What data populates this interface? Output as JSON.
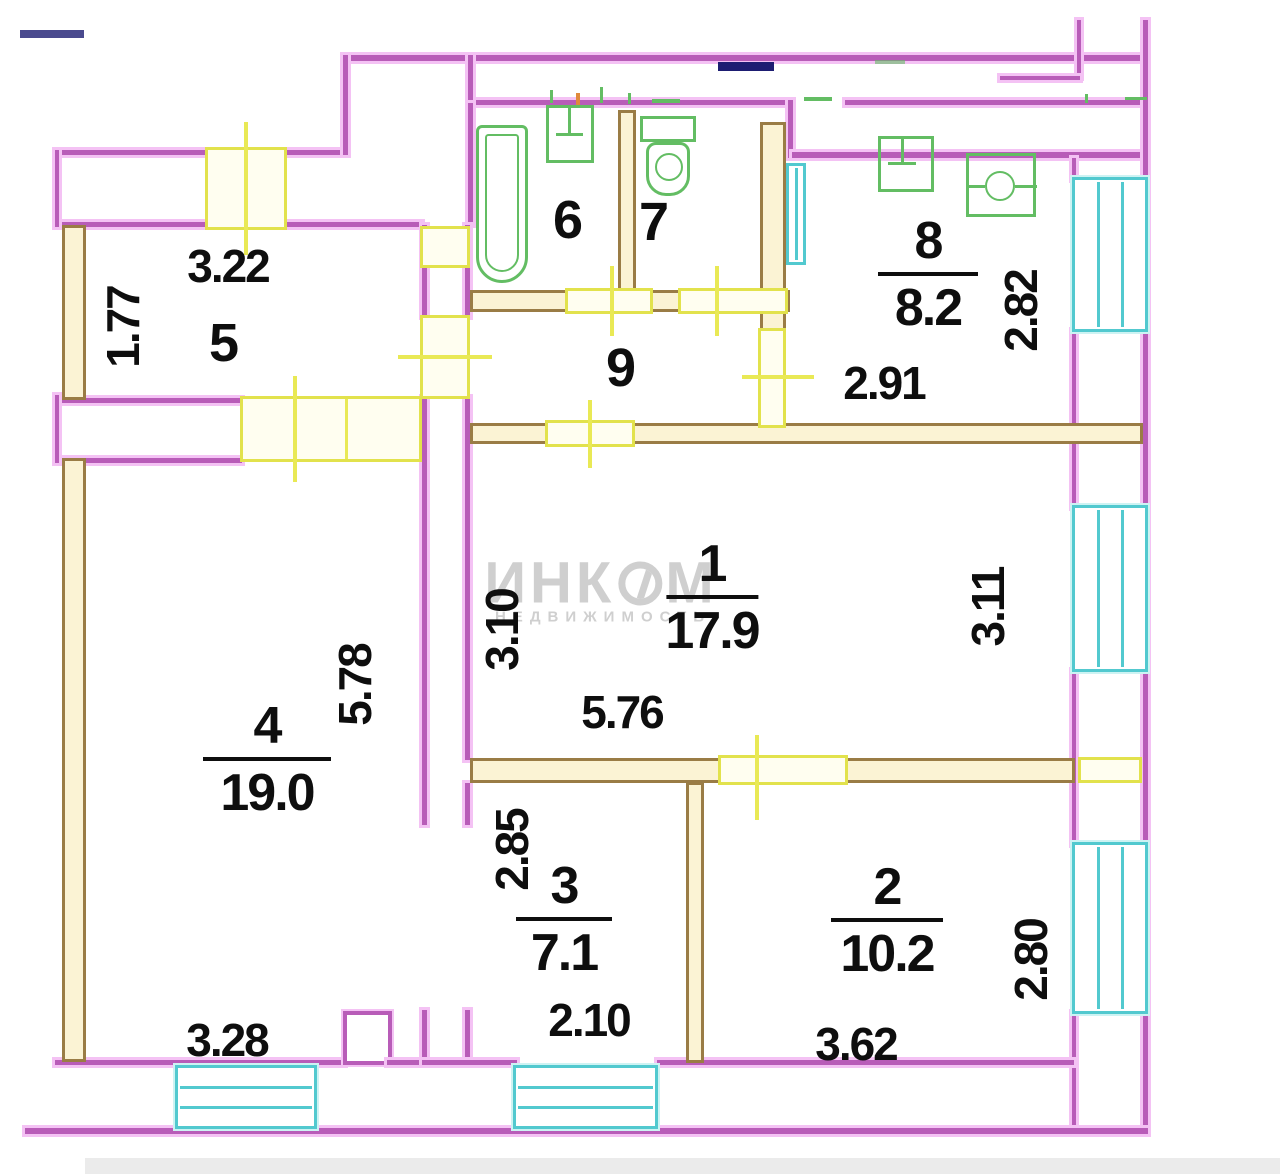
{
  "title": "apartment-floor-plan",
  "watermark": {
    "part1": "ИНК",
    "part2": "М",
    "line2": "НЕДВИЖИМОСТЬ"
  },
  "rooms": {
    "r1": {
      "number": "1",
      "area": "17.9"
    },
    "r2": {
      "number": "2",
      "area": "10.2"
    },
    "r3": {
      "number": "3",
      "area": "7.1"
    },
    "r4": {
      "number": "4",
      "area": "19.0"
    },
    "r5": {
      "number": "5"
    },
    "r6": {
      "number": "6"
    },
    "r7": {
      "number": "7"
    },
    "r8": {
      "number": "8",
      "area": "8.2"
    },
    "r9": {
      "number": "9"
    }
  },
  "dimensions": {
    "r5_width": "3.22",
    "r5_height": "1.77",
    "r8_width": "2.91",
    "r8_height": "2.82",
    "r1_left": "3.10",
    "r1_right": "3.11",
    "r1_width": "5.76",
    "r4_height": "5.78",
    "r4_width": "3.28",
    "r3_height": "2.85",
    "r3_width": "2.10",
    "r2_width": "3.62",
    "r2_height": "2.80"
  },
  "colors": {
    "wall_outer": "#b85cb8",
    "wall_outer_halo": "#f4c2f4",
    "wall_partition": "#9a7c45",
    "wall_partition_fill": "#fbf3d4",
    "door": "#e2e24c",
    "window": "#52c9cf",
    "fixture": "#63bd63",
    "duct_mark": "#1d1d72",
    "text": "#0e0e0e",
    "watermark": "#cfcfcf"
  }
}
